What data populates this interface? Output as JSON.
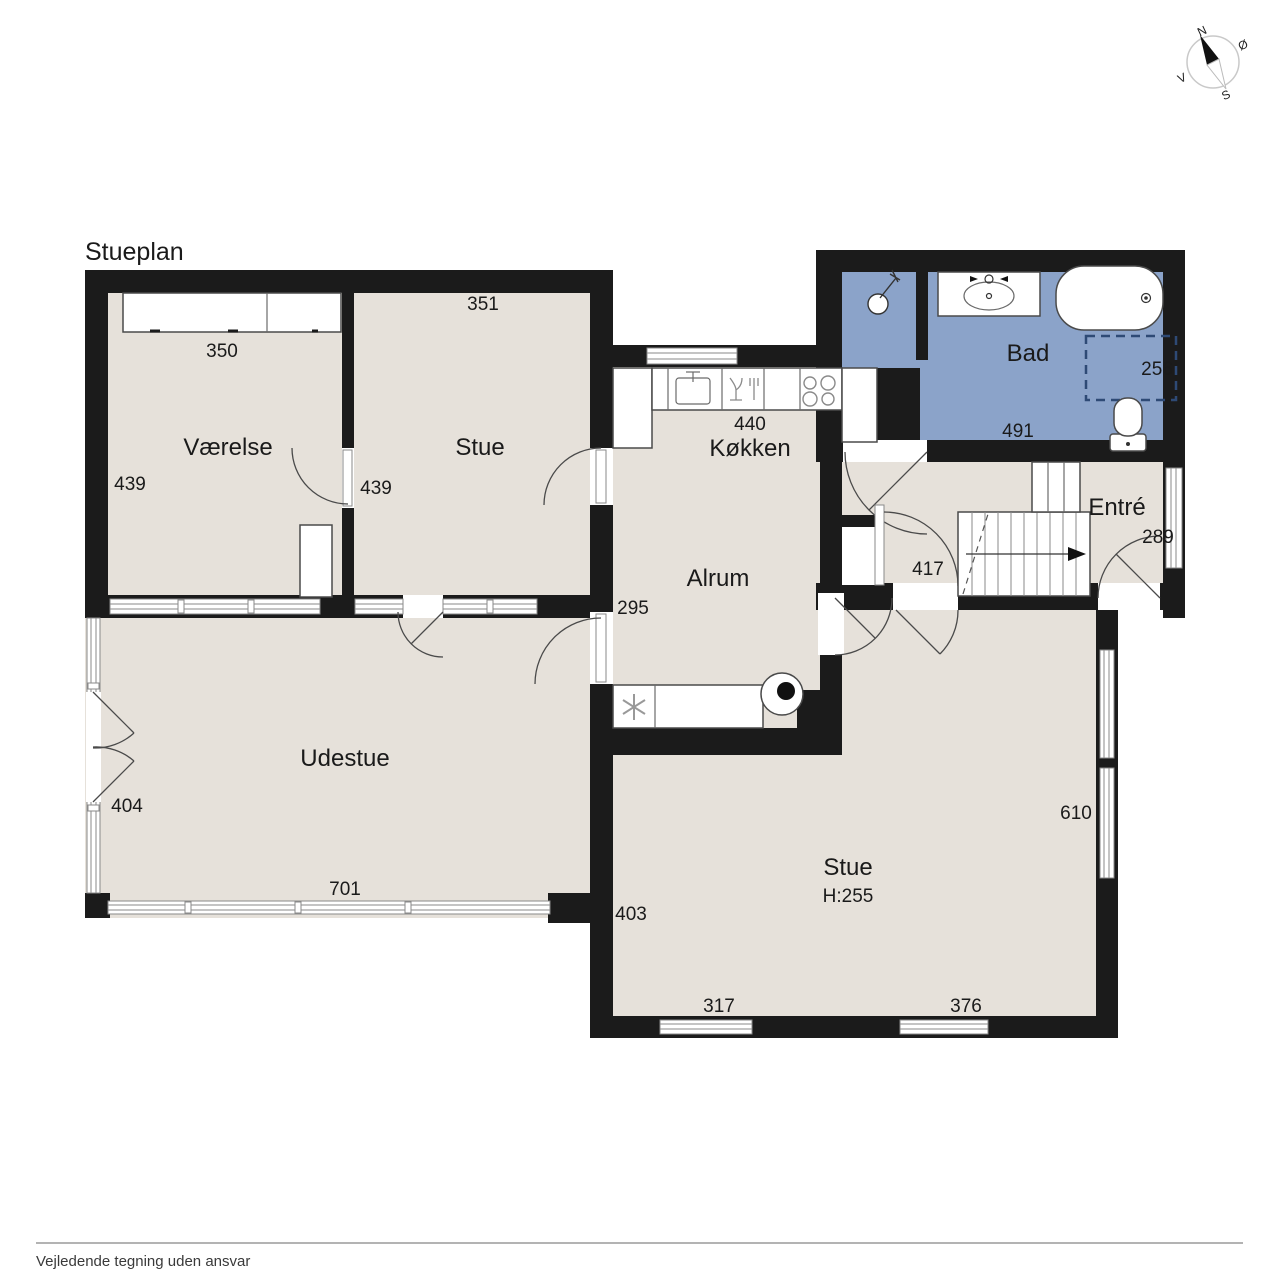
{
  "title": "Stueplan",
  "footer_note": "Vejledende tegning uden ansvar",
  "compass": {
    "north": "N",
    "east": "Ø",
    "south": "S",
    "west": "V"
  },
  "colors": {
    "wall": "#1b1b1b",
    "room_fill": "#e6e1da",
    "bath_fill": "#8ba3c9",
    "window_line": "#8a8a8a"
  },
  "rooms": {
    "vaerelse": {
      "name": "Værelse",
      "depth": "439",
      "wardrobe_width": "350"
    },
    "stue_top": {
      "name": "Stue",
      "width": "351",
      "door_dim": "439"
    },
    "koekken": {
      "name": "Køkken",
      "width": "440"
    },
    "alrum": {
      "name": "Alrum",
      "dim": "295"
    },
    "bad": {
      "name": "Bad",
      "width": "491",
      "shower": "256"
    },
    "entre": {
      "name": "Entré",
      "dim": "289"
    },
    "hall": {
      "dim": "417"
    },
    "udestue": {
      "name": "Udestue",
      "depth": "404",
      "width": "701"
    },
    "stue_bottom": {
      "name": "Stue",
      "ceiling_height": "H:255",
      "depth": "403",
      "window_left": "317",
      "window_right": "376",
      "right_depth": "610"
    }
  }
}
